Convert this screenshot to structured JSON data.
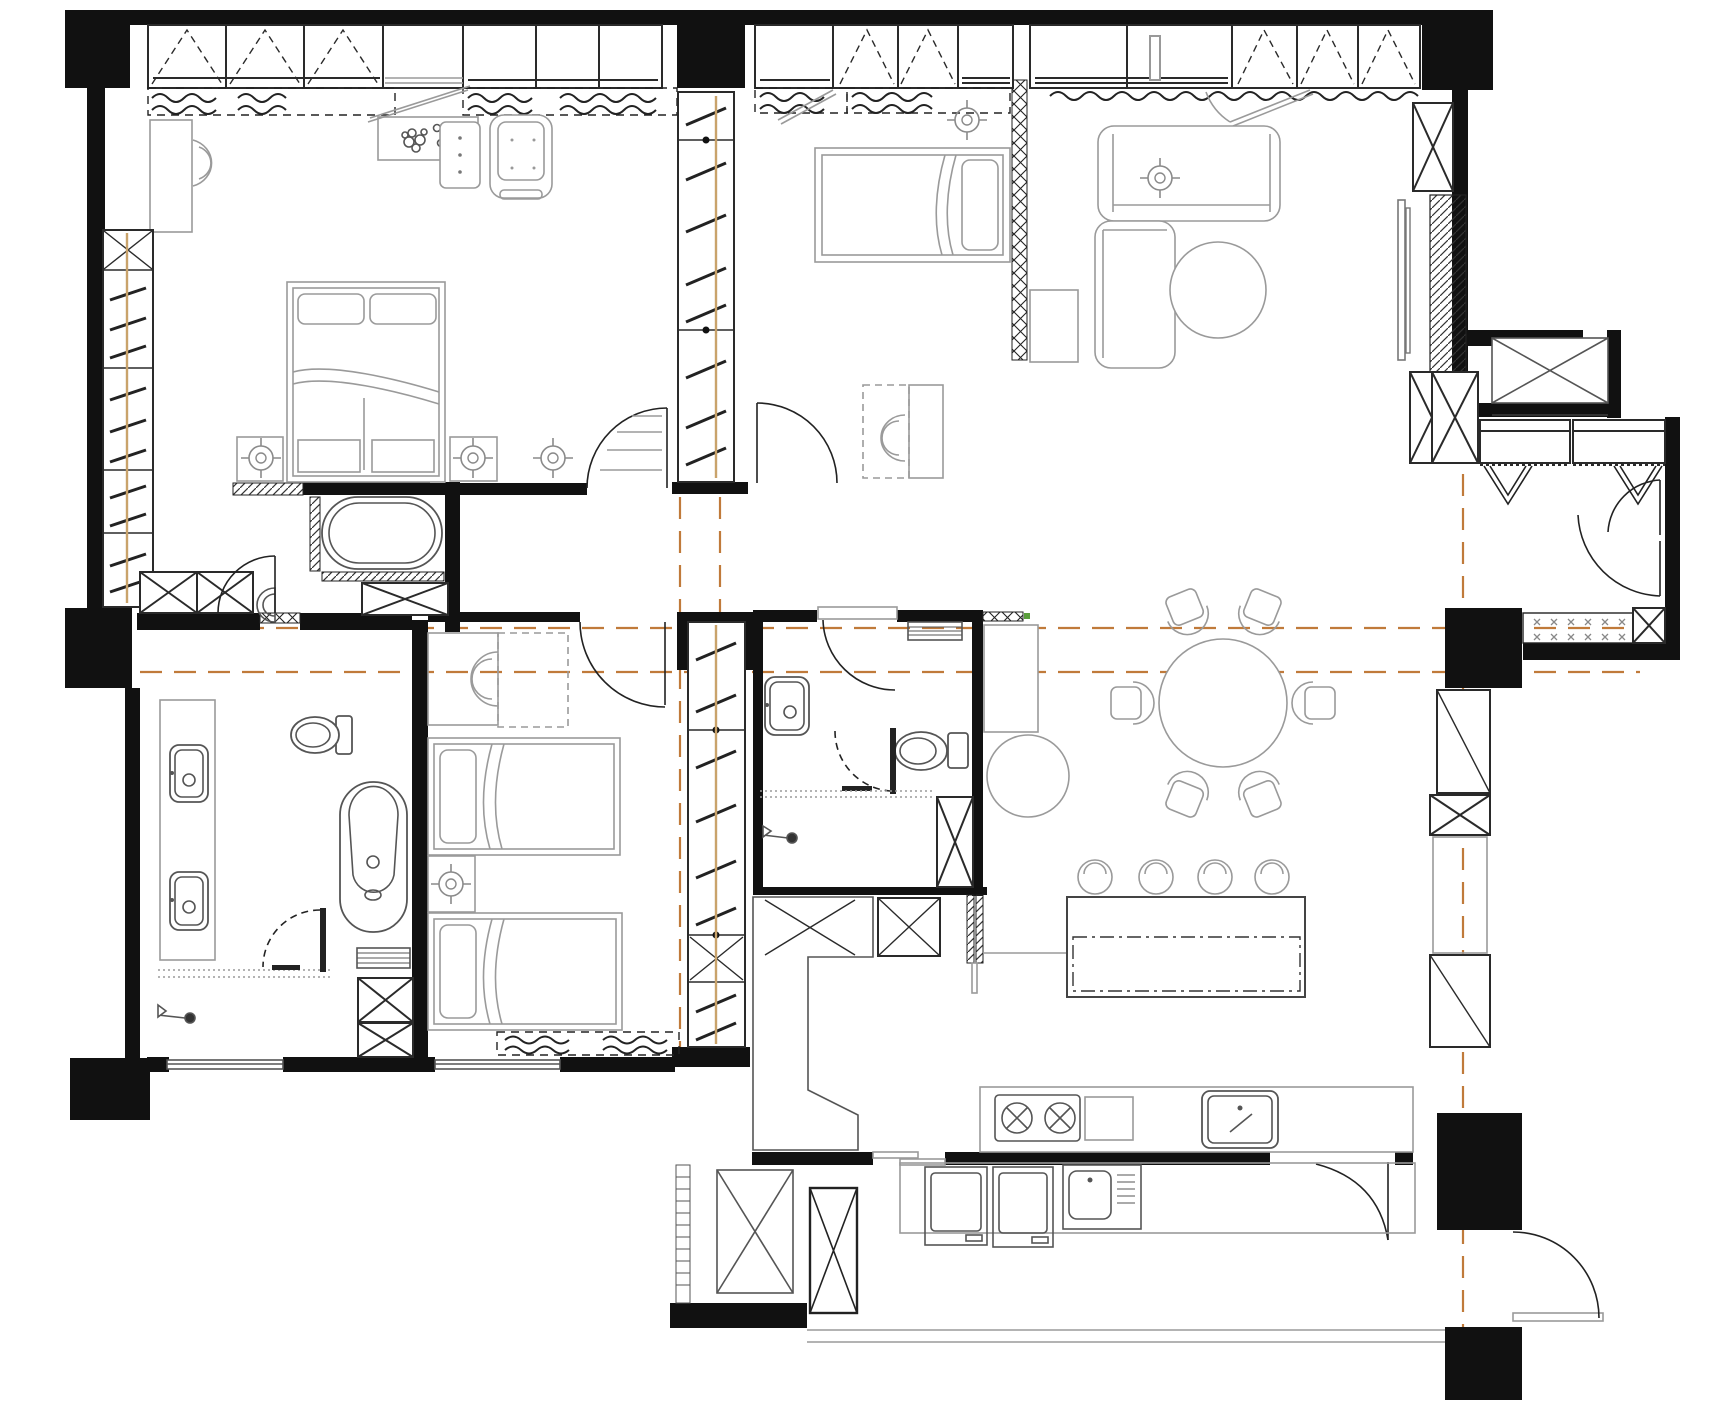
{
  "meta": {
    "title": "Apartment floor plan – black and white CAD interior layout",
    "drawing_type": "floor-plan"
  },
  "colors": {
    "background": "#ffffff",
    "walls": "#111111",
    "furniture_line": "#9a9a9a",
    "fixture_line": "#555555",
    "door_line": "#222222",
    "datum_line": "#c07a3a",
    "pole_line": "#c9a36b",
    "accent_green": "#5a9e3c",
    "hatch_line": "#333333"
  },
  "rooms": [
    {
      "name": "master-bedroom",
      "furniture": [
        "wardrobe-run-6-doors",
        "window-curtains",
        "vanity-desk-with-stool",
        "plant-shelf",
        "three-drawer-dresser",
        "armchair",
        "double-bed",
        "nightstand-left",
        "nightstand-right",
        "ceiling-light-pair",
        "tall-shelving-closet"
      ]
    },
    {
      "name": "bedroom-2",
      "furniture": [
        "wardrobe-run",
        "window-curtains",
        "single-bed",
        "desk-with-chair",
        "low-cabinet",
        "ceiling-light",
        "lattice-partition-screen"
      ]
    },
    {
      "name": "living-room",
      "furniture": [
        "l-shaped-sofa",
        "round-ottoman",
        "tv-panel",
        "hatched-media-wall",
        "crossed-cabinets",
        "window-curtain",
        "ceiling-light"
      ]
    },
    {
      "name": "dining-area",
      "furniture": [
        "round-table",
        "six-chairs",
        "sideboard",
        "round-pouf"
      ]
    },
    {
      "name": "kitchen",
      "furniture": [
        "island-counter",
        "four-bar-stools",
        "l-shaped-counter",
        "two-burner-hob",
        "kitchen-sink",
        "upper-crossed-cabinets",
        "pocket-door",
        "pantry-tall-units"
      ]
    },
    {
      "name": "master-bathroom",
      "furniture": [
        "built-in-oval-tub",
        "wall-basin",
        "crossed-cabinet-row",
        "entry-door"
      ]
    },
    {
      "name": "bathroom-2",
      "furniture": [
        "double-vanity-sinks",
        "toilet",
        "freestanding-tub",
        "shower-enclosure",
        "towel-rack",
        "crossed-cabinets",
        "shower-head"
      ]
    },
    {
      "name": "central-bathroom",
      "furniture": [
        "sink",
        "toilet",
        "shower-enclosure",
        "towel-rack",
        "crossed-cabinet",
        "swing-door"
      ]
    },
    {
      "name": "twin-bedroom",
      "furniture": [
        "single-bed-a",
        "single-bed-b",
        "nightstand-with-light",
        "desk-with-chair",
        "window-curtain"
      ]
    },
    {
      "name": "entry-foyer",
      "furniture": [
        "shoe-cabinet-left",
        "shoe-cabinet-right",
        "double-entry-door",
        "entry-mat",
        "crossed-box"
      ]
    },
    {
      "name": "ac-balcony",
      "furniture": [
        "equipment-platform"
      ]
    },
    {
      "name": "utility-balcony",
      "furniture": [
        "washer",
        "dryer",
        "laundry-sink-with-drainboard",
        "crossed-cabinet-large",
        "crossed-cabinet-tall",
        "ladder-strip",
        "service-door"
      ]
    },
    {
      "name": "corridor",
      "furniture": [
        "louver-door-master",
        "swing-door-bedroom2",
        "swing-door-twin-bedroom",
        "ceiling-light",
        "datum-lines"
      ]
    }
  ]
}
